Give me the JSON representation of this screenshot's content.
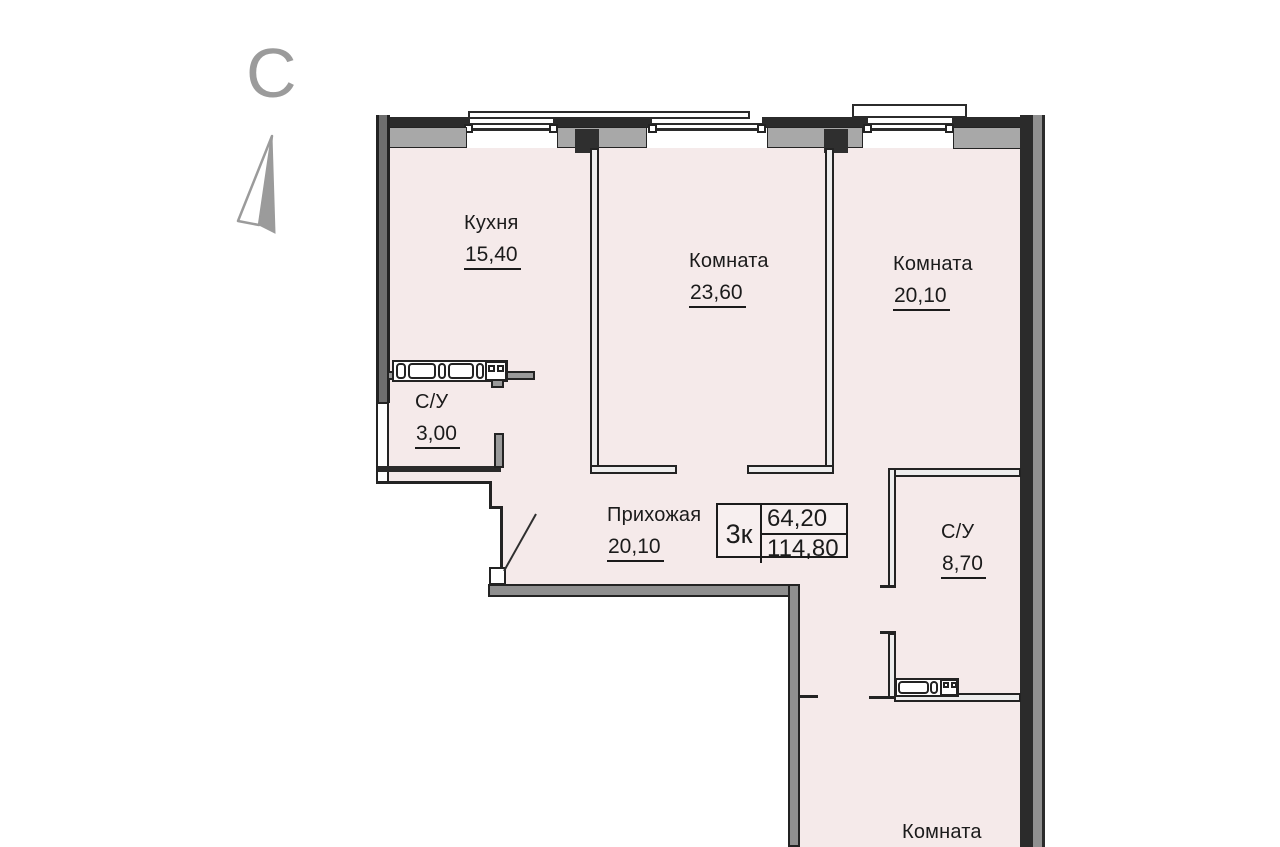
{
  "compass": {
    "north_label": "С"
  },
  "plan": {
    "rooms": {
      "kitchen": {
        "name": "Кухня",
        "area": "15,40"
      },
      "living1": {
        "name": "Комната",
        "area": "23,60"
      },
      "living2": {
        "name": "Комната",
        "area": "20,10"
      },
      "wc_small": {
        "name": "С/У",
        "area": "3,00"
      },
      "hall": {
        "name": "Прихожая",
        "area": "20,10"
      },
      "wc_big": {
        "name": "С/У",
        "area": "8,70"
      },
      "living3": {
        "name": "Комната"
      }
    },
    "summary": {
      "flat_type": "3к",
      "living_area": "64,20",
      "total_area": "114,80"
    },
    "colors": {
      "interior_fill": "#f5eaea",
      "wall_dark": "#2b2b2b",
      "wall_gray": "#8f8f8f",
      "sill_gray": "#a8a8a8",
      "compass_gray": "#9b9b9b",
      "text": "#1b1b1b"
    }
  }
}
